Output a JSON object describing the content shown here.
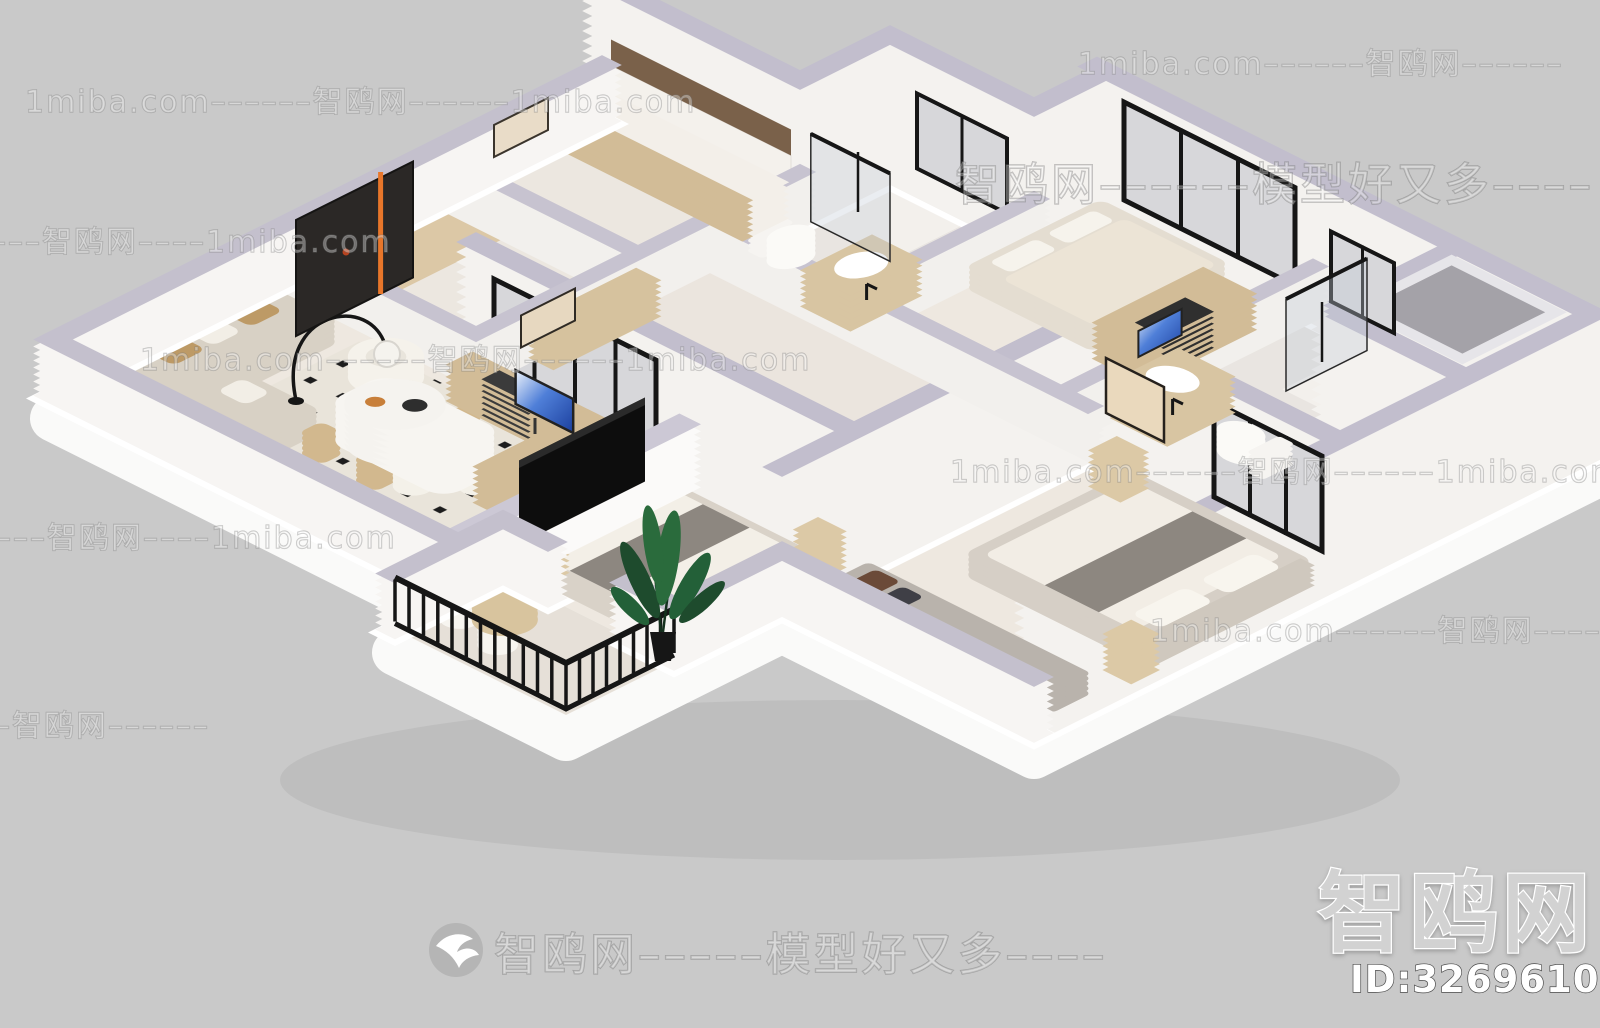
{
  "image_type": "3d-isometric-apartment-floorplan-render",
  "watermarks": {
    "brand": "智鸥网",
    "site": "1miba.com",
    "slogan": "模型好又多",
    "model_id": "ID:326961044",
    "logo_icon": "seagull-bird-logo",
    "rows": [
      {
        "text": "1miba.com––––––智鸥网––––––"
      },
      {
        "text": "1miba.com––––––智鸥网––––––1miba.com"
      },
      {
        "text": "智鸥网––––––模型好又多––––"
      },
      {
        "text": "––––––智鸥网––––1miba.com"
      },
      {
        "text": "1miba.com––––––智鸥网––––––1miba.com"
      },
      {
        "text": "1miba.com––––––智鸥网––––––1miba.com"
      },
      {
        "text": "––––––智鸥网––––1miba.com"
      },
      {
        "text": "1miba.com––––––智鸥网––––"
      },
      {
        "text": "––––––智鸥网––––––"
      },
      {
        "text": "智鸥网–––––模型好又多––––"
      }
    ]
  },
  "colors": {
    "background": "#c9c9c9",
    "wall_top": "#c2becd",
    "wall_face": "#f4f2ef",
    "floor": "#eee8e0",
    "wood": "#d2bc97",
    "accent_orange": "#e8762a",
    "railing_black": "#161616",
    "tv_black": "#0d0d0d",
    "plant_green": "#2a6b3c"
  }
}
